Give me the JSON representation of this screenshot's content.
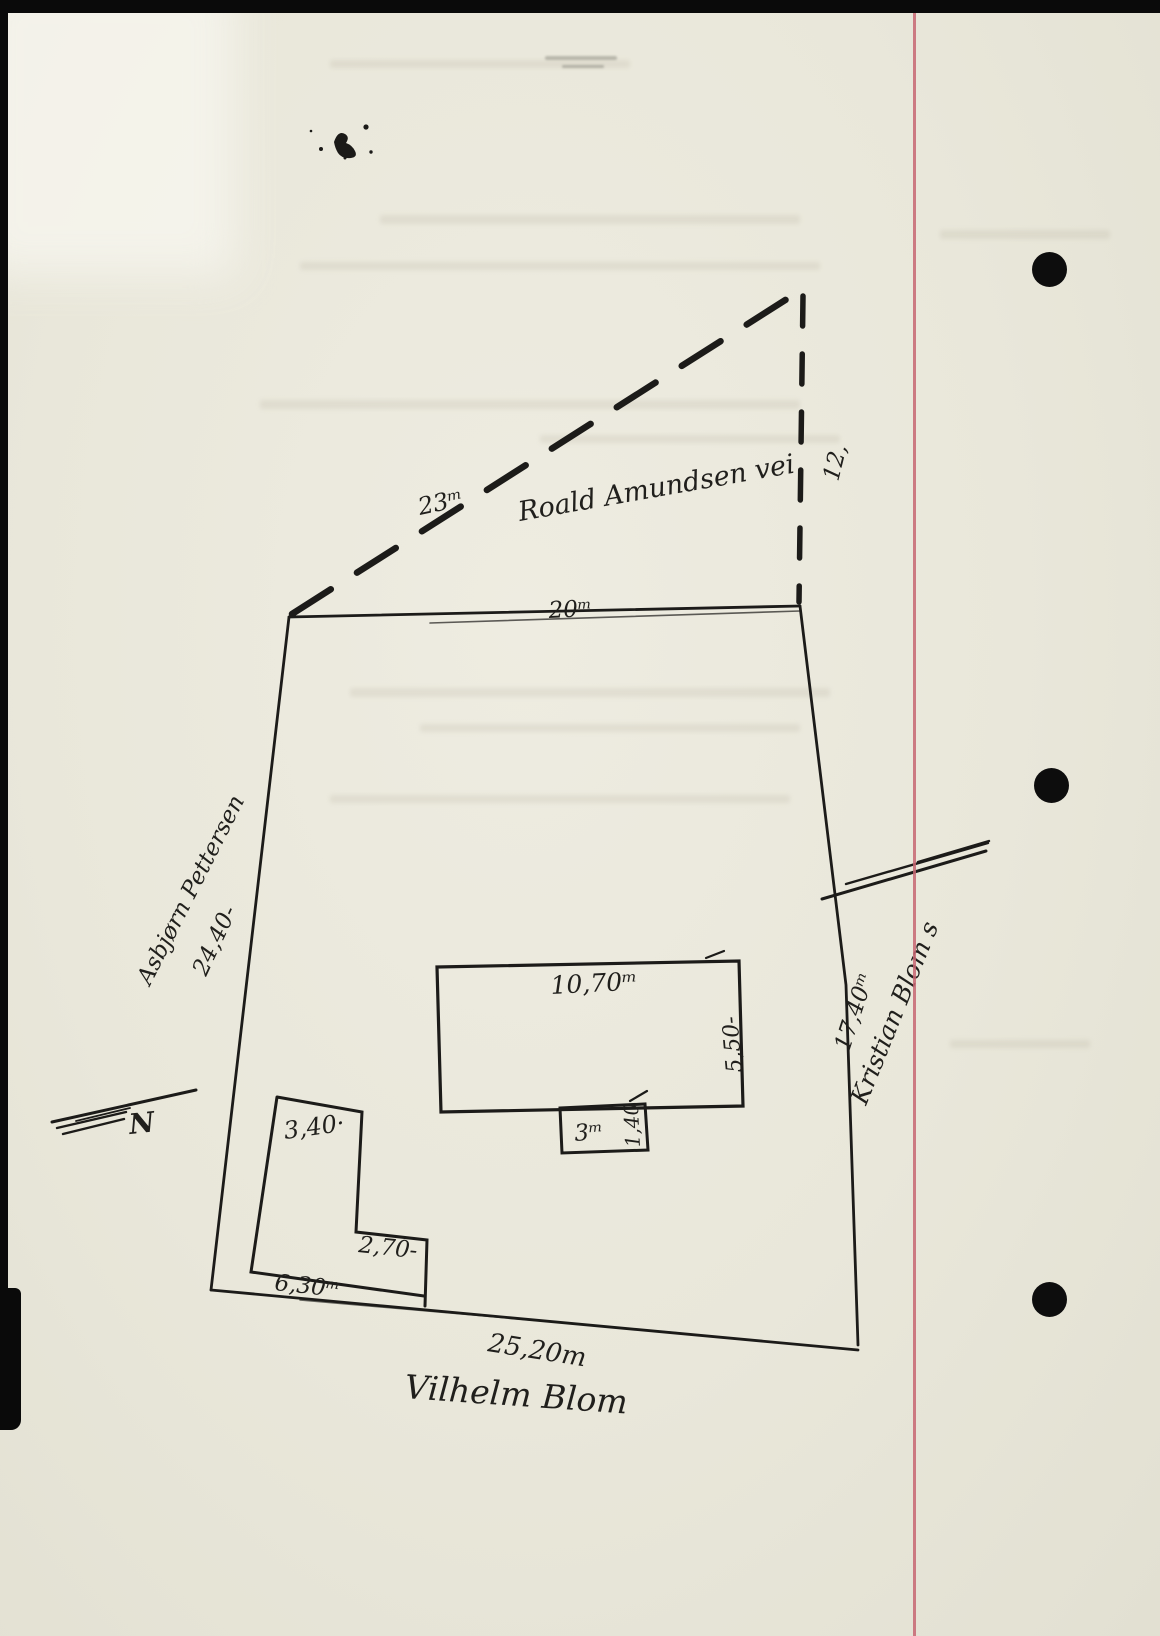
{
  "sketch": {
    "street": {
      "name": "Roald Amundsen vei",
      "frontage_left": "23ᵐ",
      "frontage_right": "12,"
    },
    "plot": {
      "top_width": "20ᵐ",
      "left_length": "24,40-",
      "left_neighbor": "Asbjørn Pettersen",
      "right_length": "17,40ᵐ",
      "right_neighbor": "Kristian Blom s",
      "bottom_length": "25,20m",
      "bottom_neighbor": "Vilhelm Blom"
    },
    "main_building": {
      "width": "10,70ᵐ",
      "depth": "5,50-",
      "annex_width": "3ᵐ",
      "annex_depth": "1,40"
    },
    "outbuilding": {
      "top_width": "3,40·",
      "step_width": "2,70-",
      "bottom_width": "6,30ᵐ"
    },
    "compass": {
      "north": "N"
    }
  }
}
